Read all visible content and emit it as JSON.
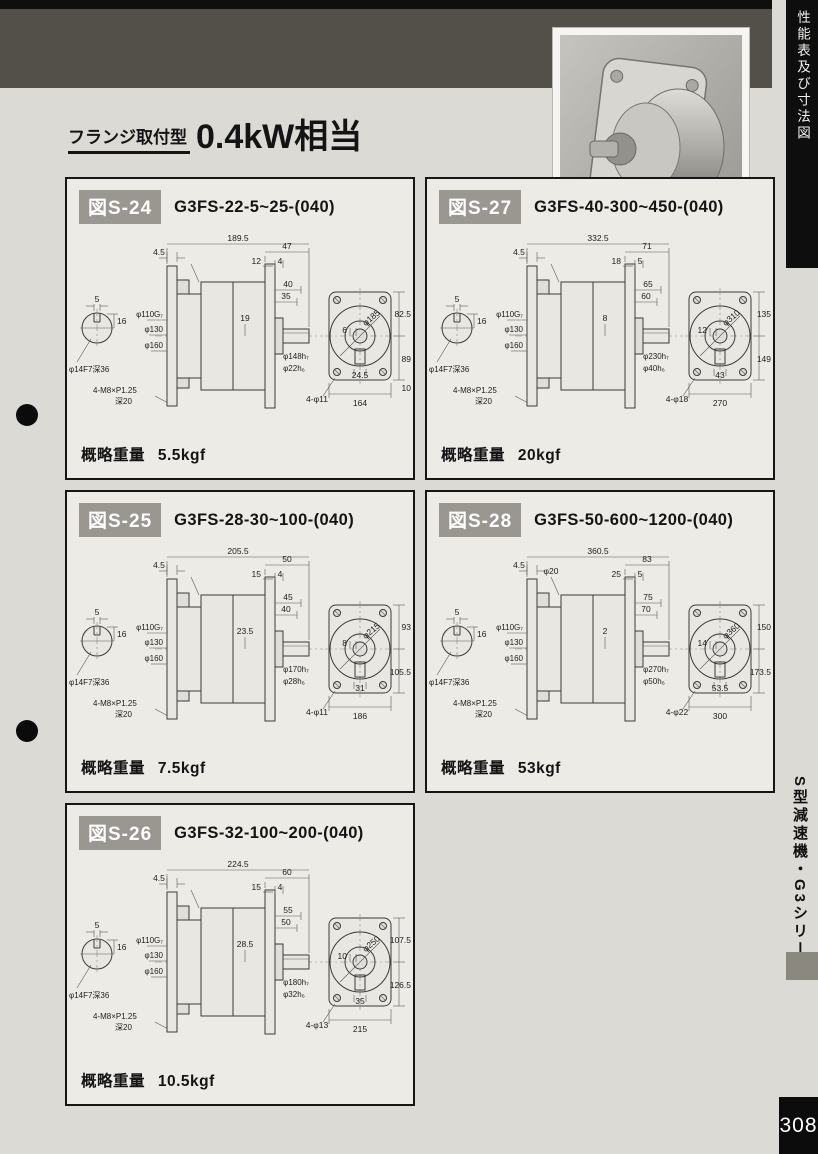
{
  "page": {
    "side_tab": "性能表及び寸法図",
    "side_series": "S型減速機・G3シリーズ",
    "page_number": "308",
    "title_prefix": "フランジ取付型",
    "title_main": "0.4kW相当"
  },
  "figures": [
    {
      "id": "図S-24",
      "model": "G3FS-22-5~25-(040)",
      "weight_label": "概略重量",
      "weight": "5.5kgf",
      "dims": {
        "key_w": "5",
        "key_h": "16",
        "shaft_note": "φ14F7深36",
        "bolt_note": "4-M8×P1.25",
        "bolt_note2": "深20",
        "overall": "189.5",
        "flange_t": "4.5",
        "top1": "47",
        "top2": "12",
        "top3": "4",
        "extra": "",
        "spigot": "φ110G₇",
        "bolt_circle": "φ130",
        "flange_od": "φ160",
        "body": "19",
        "out1": "40",
        "out2": "35",
        "out_d1": "φ148h₇",
        "out_d2": "φ22h₆",
        "front_diag": "φ185",
        "front_key": "6",
        "front_boss": "24.5",
        "front_r1": "82.5",
        "front_r2": "89",
        "front_r3": "10",
        "front_w": "164",
        "holes": "4-φ11"
      }
    },
    {
      "id": "図S-27",
      "model": "G3FS-40-300~450-(040)",
      "weight_label": "概略重量",
      "weight": "20kgf",
      "dims": {
        "key_w": "5",
        "key_h": "16",
        "shaft_note": "φ14F7深36",
        "bolt_note": "4-M8×P1.25",
        "bolt_note2": "深20",
        "overall": "332.5",
        "flange_t": "4.5",
        "top1": "71",
        "top2": "18",
        "top3": "5",
        "extra": "",
        "spigot": "φ110G₇",
        "bolt_circle": "φ130",
        "flange_od": "φ160",
        "body": "8",
        "out1": "65",
        "out2": "60",
        "out_d1": "φ230h₇",
        "out_d2": "φ40h₆",
        "front_diag": "φ310",
        "front_key": "12",
        "front_boss": "43",
        "front_r1": "135",
        "front_r2": "149",
        "front_r3": "",
        "front_w": "270",
        "holes": "4-φ18"
      }
    },
    {
      "id": "図S-25",
      "model": "G3FS-28-30~100-(040)",
      "weight_label": "概略重量",
      "weight": "7.5kgf",
      "dims": {
        "key_w": "5",
        "key_h": "16",
        "shaft_note": "φ14F7深36",
        "bolt_note": "4-M8×P1.25",
        "bolt_note2": "深20",
        "overall": "205.5",
        "flange_t": "4.5",
        "top1": "50",
        "top2": "15",
        "top3": "4",
        "extra": "",
        "spigot": "φ110G₇",
        "bolt_circle": "φ130",
        "flange_od": "φ160",
        "body": "23.5",
        "out1": "45",
        "out2": "40",
        "out_d1": "φ170h₇",
        "out_d2": "φ28h₆",
        "front_diag": "φ215",
        "front_key": "8",
        "front_boss": "31",
        "front_r1": "93",
        "front_r2": "105.5",
        "front_r3": "",
        "front_w": "186",
        "holes": "4-φ11"
      }
    },
    {
      "id": "図S-28",
      "model": "G3FS-50-600~1200-(040)",
      "weight_label": "概略重量",
      "weight": "53kgf",
      "dims": {
        "key_w": "5",
        "key_h": "16",
        "shaft_note": "φ14F7深36",
        "bolt_note": "4-M8×P1.25",
        "bolt_note2": "深20",
        "overall": "360.5",
        "flange_t": "4.5",
        "top1": "83",
        "top2": "25",
        "top3": "5",
        "extra": "φ20",
        "spigot": "φ110G₇",
        "bolt_circle": "φ130",
        "flange_od": "φ160",
        "body": "2",
        "out1": "75",
        "out2": "70",
        "out_d1": "φ270h₇",
        "out_d2": "φ50h₆",
        "front_diag": "φ360",
        "front_key": "14",
        "front_boss": "53.5",
        "front_r1": "150",
        "front_r2": "173.5",
        "front_r3": "",
        "front_w": "300",
        "holes": "4-φ22"
      }
    },
    {
      "id": "図S-26",
      "model": "G3FS-32-100~200-(040)",
      "weight_label": "概略重量",
      "weight": "10.5kgf",
      "dims": {
        "key_w": "5",
        "key_h": "16",
        "shaft_note": "φ14F7深36",
        "bolt_note": "4-M8×P1.25",
        "bolt_note2": "深20",
        "overall": "224.5",
        "flange_t": "4.5",
        "top1": "60",
        "top2": "15",
        "top3": "4",
        "extra": "",
        "spigot": "φ110G₇",
        "bolt_circle": "φ130",
        "flange_od": "φ160",
        "body": "28.5",
        "out1": "55",
        "out2": "50",
        "out_d1": "φ180h₇",
        "out_d2": "φ32h₆",
        "front_diag": "φ250",
        "front_key": "10",
        "front_boss": "35",
        "front_r1": "107.5",
        "front_r2": "126.5",
        "front_r3": "",
        "front_w": "215",
        "holes": "4-φ13"
      }
    }
  ]
}
